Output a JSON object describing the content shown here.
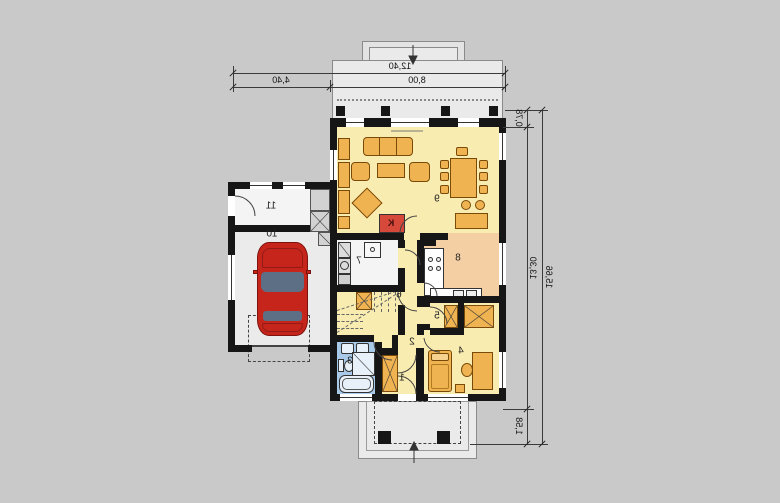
{
  "dimensions": {
    "top_total": "12,40",
    "top_garage": "4,40",
    "top_house": "8,00",
    "right_terrace": "0,78",
    "right_house": "13,30",
    "right_total": "15,66",
    "right_porch": "1,58"
  },
  "rooms": [
    {
      "number": "1"
    },
    {
      "number": "2"
    },
    {
      "number": "3"
    },
    {
      "number": "4"
    },
    {
      "number": "5"
    },
    {
      "number": "6"
    },
    {
      "number": "7"
    },
    {
      "number": "8"
    },
    {
      "number": "9"
    },
    {
      "number": "10"
    },
    {
      "number": "11"
    }
  ],
  "fireplace_label": "K",
  "colors": {
    "bg": "#c9c9c9",
    "wall": "#161616",
    "yellow": "#f8ecb0",
    "salmon": "#f5cfa4",
    "blue": "#a9c9e9",
    "orange": "#f0b352",
    "red": "#d6483a",
    "car": "#c6251c",
    "terrace": "#eaeaea"
  }
}
